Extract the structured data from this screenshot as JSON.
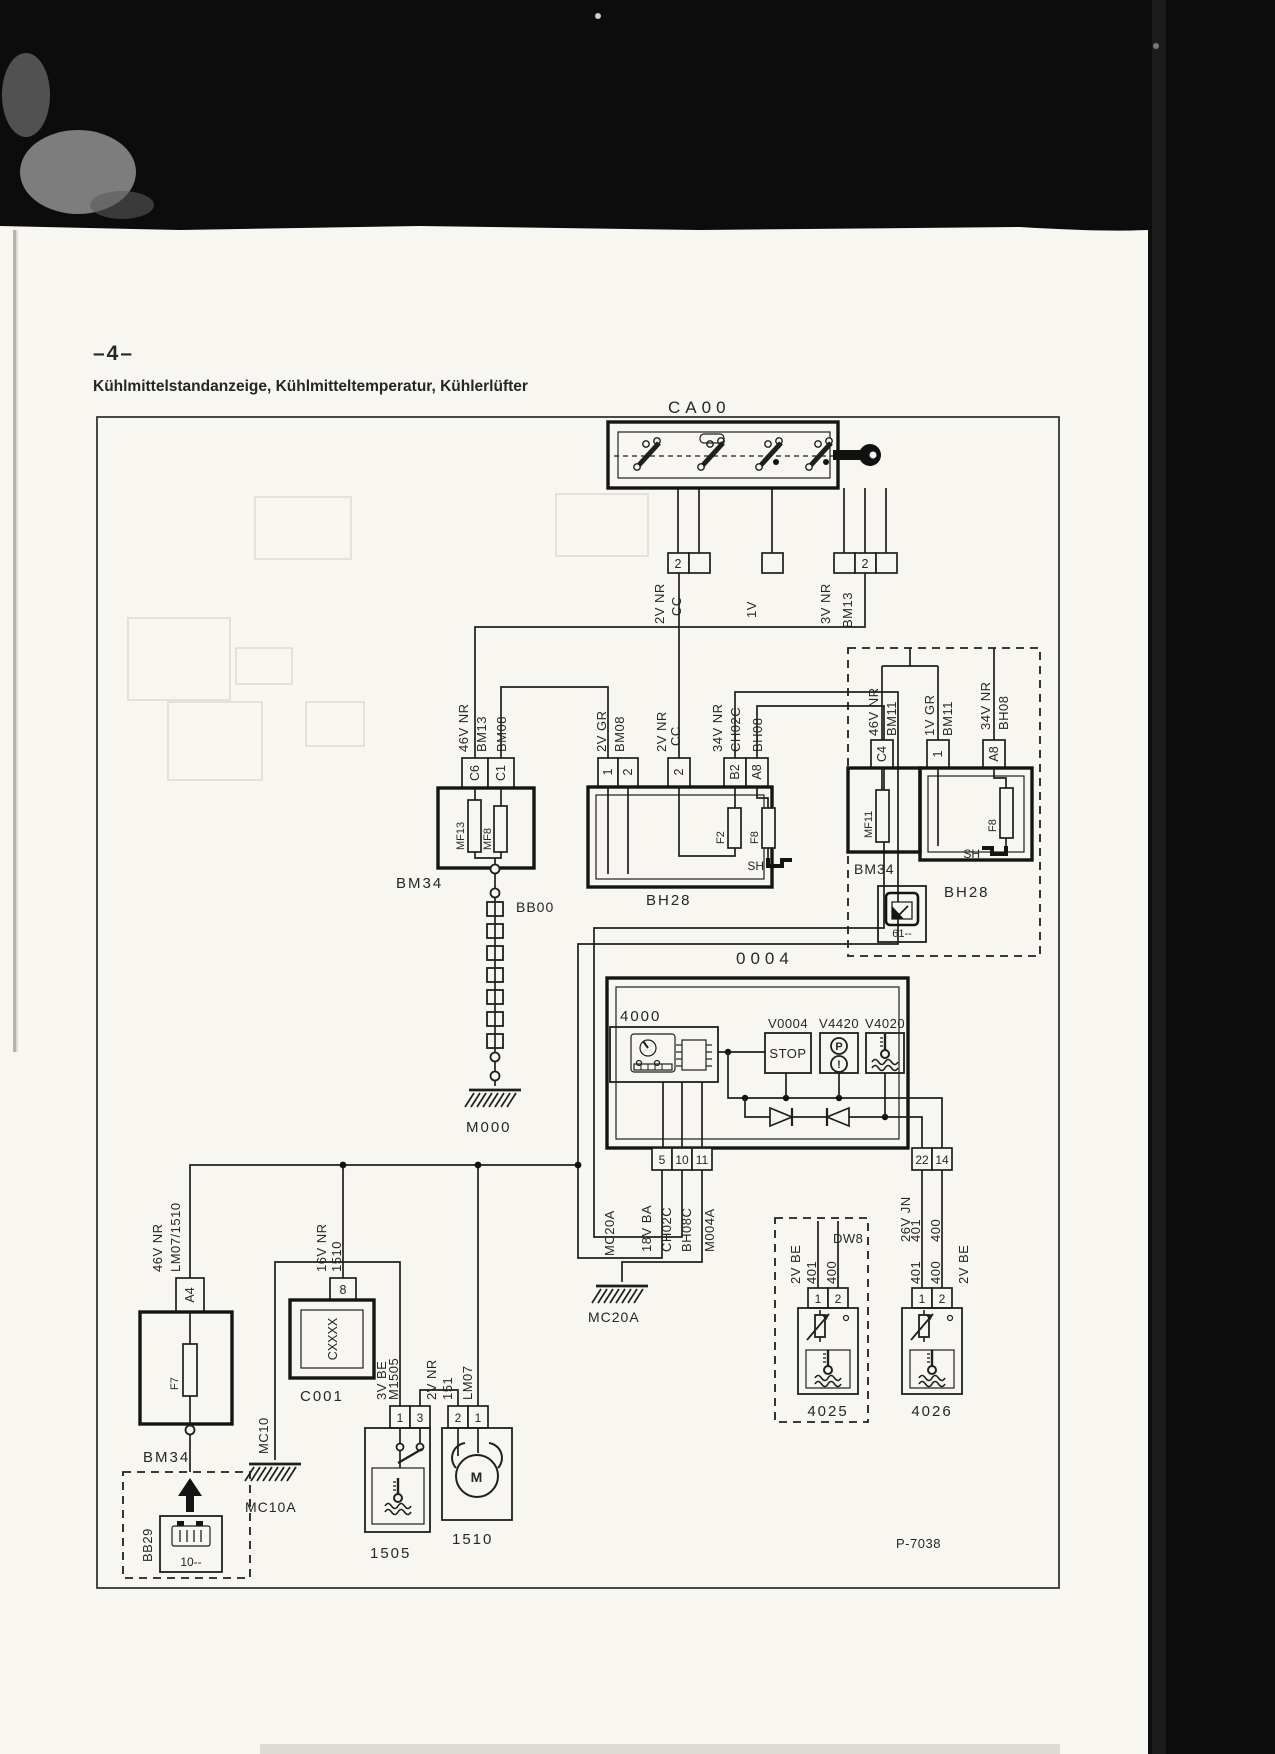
{
  "header": {
    "page_number": "–4–",
    "title": "Kühlmittelstandanzeige, Kühlmitteltemperatur, Kühlerlüfter"
  },
  "footer": {
    "drawing_number": "P-7038"
  },
  "icons": {
    "parking_brake": "P",
    "warning": "!",
    "motor": "M"
  },
  "ca00": {
    "id": "CA00",
    "conn_a_pin": "2",
    "conn_c_pin": "2",
    "wire_a1": "2V NR",
    "wire_a2": "CC",
    "wire_b1": "1V",
    "wire_c1": "3V NR",
    "wire_c2": "BM13"
  },
  "bm34_left": {
    "id": "BM34",
    "wire1": "46V NR",
    "wire2": "BM13",
    "wire3": "BM08",
    "pin_a": "C6",
    "pin_b": "C1",
    "fuse_a": "MF13",
    "fuse_b": "MF8"
  },
  "bb00": {
    "id": "BB00"
  },
  "m000": {
    "id": "M000"
  },
  "bh28_mid": {
    "id": "BH28",
    "wire1a": "2V GR",
    "wire1b": "BM08",
    "pin1": "1",
    "pin2": "2",
    "wire2a": "2V NR",
    "wire2b": "CC",
    "pin3": "2",
    "wire3a": "34V NR",
    "wire3b": "CH02C",
    "wire3c": "BH08",
    "pin4": "B2",
    "pin5": "A8",
    "fuse_a": "F2",
    "fuse_b": "F8",
    "shunt": "SH"
  },
  "option_box": {
    "wire1a": "46V NR",
    "wire1b": "BM11",
    "pin1": "C4",
    "wire2a": "1V GR",
    "wire2b": "BM11",
    "pin2": "1",
    "wire3a": "34V NR",
    "wire3b": "BH08",
    "pin3": "A8",
    "fuse_box_id": "BM34",
    "fuse": "MF11",
    "relay_box_id": "BH28",
    "fuse2": "F8",
    "shunt": "SH",
    "ref": "61--"
  },
  "unit_0004": {
    "id": "0004",
    "cluster_id": "4000",
    "lamp1": "V0004",
    "lamp2": "V4420",
    "lamp3": "V4020",
    "stop": "STOP",
    "pin5": "5",
    "pin10": "10",
    "pin11": "11",
    "wl1": "18V BA",
    "wl2": "CH02C",
    "wl3": "BH08C",
    "wl4": "M004A",
    "pin22": "22",
    "pin14": "14",
    "wr1": "26V JN",
    "wr2": "401",
    "wr3": "400"
  },
  "mc20a": {
    "wire": "MC20A",
    "label": "MC20A"
  },
  "dw8": {
    "id": "DW8",
    "wire1": "2V BE",
    "wire2": "401",
    "wire3": "400",
    "pin1": "1",
    "pin2": "2",
    "sensor_id": "4025"
  },
  "sensor_4026": {
    "id": "4026",
    "wire1": "401",
    "wire2": "400",
    "wire3": "2V BE",
    "pin1": "1",
    "pin2": "2"
  },
  "bm34_bottom": {
    "id": "BM34",
    "wire1": "46V NR",
    "wire2": "LM07/1510",
    "pin": "A4",
    "fuse": "F7"
  },
  "bb29": {
    "id": "BB29",
    "ref": "10--"
  },
  "c001": {
    "id": "C001",
    "wire1": "16V NR",
    "wire2": "1510",
    "pin": "8",
    "module": "CXXXX"
  },
  "mc10": {
    "wire": "MC10",
    "label": "MC10A"
  },
  "sensor_1505": {
    "id": "1505",
    "wire1": "3V BE",
    "wire2": "M1505",
    "pin1": "1",
    "pin2": "3"
  },
  "motor_1510": {
    "id": "1510",
    "wire1": "2V NR",
    "wire2": "151",
    "wire3": "LM07",
    "pin1": "2",
    "pin2": "1"
  }
}
